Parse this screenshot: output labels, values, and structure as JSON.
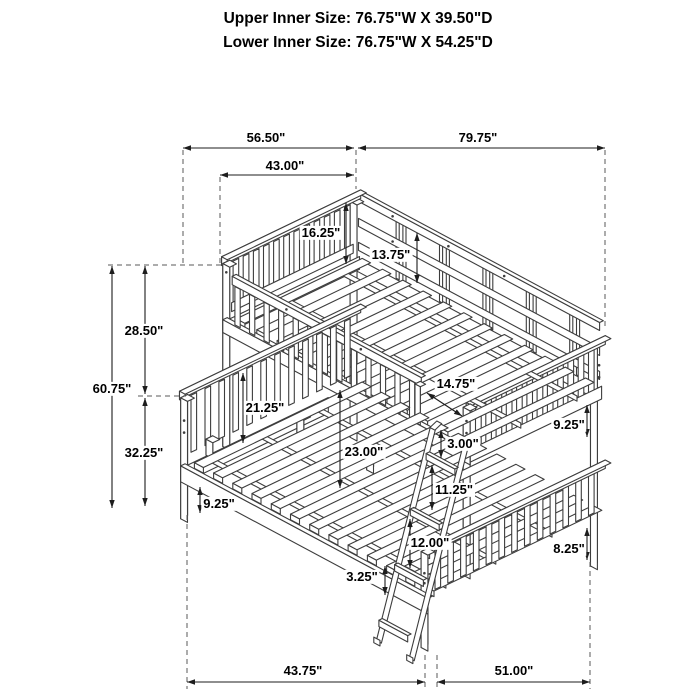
{
  "title": {
    "line1": "Upper Inner Size: 76.75\"W X 39.50\"D",
    "line2": "Lower Inner Size: 76.75\"W X 54.25\"D"
  },
  "dims": {
    "top_span_left": "56.50\"",
    "top_span_right": "79.75\"",
    "top_span_inner": "43.00\"",
    "headboard_above_rail": "16.25\"",
    "guardrail_above_deck": "13.75\"",
    "upper_section_height": "28.50\"",
    "overall_height": "60.75\"",
    "lower_section_height": "32.25\"",
    "underbed_clearance_left": "9.25\"",
    "bunk_gap_rear": "21.25\"",
    "bunk_gap_center": "23.00\"",
    "ladder_opening_width": "14.75\"",
    "rail_height": "3.00\"",
    "ladder_step_gap": "11.25\"",
    "ladder_step_spacing": "12.00\"",
    "ladder_bottom_step": "3.25\"",
    "footboard_gap_right": "9.25\"",
    "underbed_clearance_right": "8.25\"",
    "bottom_span_left": "43.75\"",
    "bottom_span_right": "51.00\""
  },
  "colors": {
    "background": "#ffffff",
    "line_art": "#3d3d3d",
    "dimension_lines": "#1d1d1d",
    "text": "#000000"
  }
}
